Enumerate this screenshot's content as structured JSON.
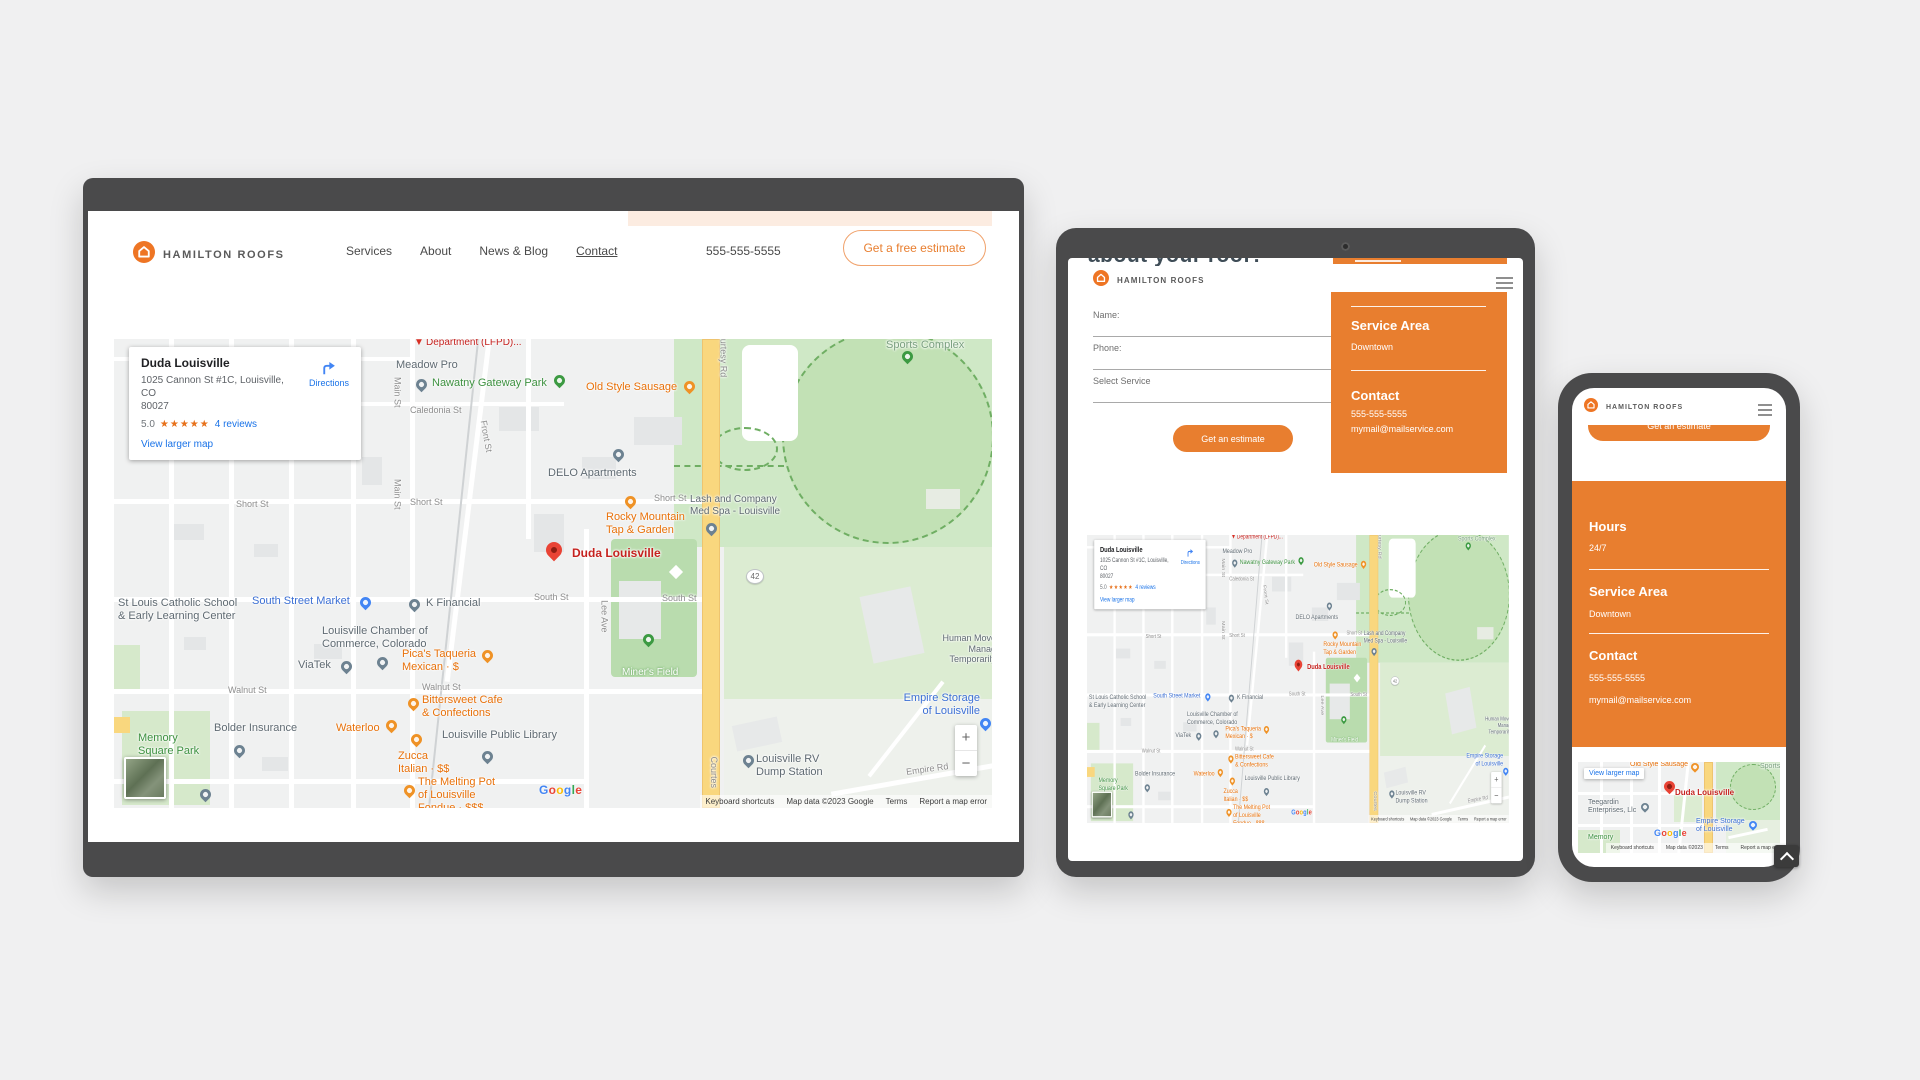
{
  "brand": {
    "name": "HAMILTON ROOFS"
  },
  "desktop": {
    "nav": [
      "Services",
      "About",
      "News & Blog",
      "Contact"
    ],
    "phone": "555-555-5555",
    "cta": "Get a free estimate"
  },
  "map": {
    "card": {
      "title": "Duda Louisville",
      "address_line1": "1025 Cannon St #1C, Louisville, CO",
      "address_line2": "80027",
      "rating": "5.0",
      "stars": "★★★★★",
      "reviews_link": "4 reviews",
      "view_larger_link": "View larger map",
      "directions_label": "Directions"
    },
    "zoom_in": "+",
    "zoom_out": "−",
    "google_logo": "Google",
    "attribution": [
      "Keyboard shortcuts",
      "Map data ©2023 Google",
      "Terms",
      "Report a map error"
    ],
    "labels": [
      {
        "t": "Department (LFPD)...",
        "x": 312,
        "y": -2,
        "c": "red"
      },
      {
        "t": "Meadow Pro",
        "x": 282,
        "y": 20,
        "c": "gray",
        "fs": 11
      },
      {
        "t": "Nawatny Gateway Park",
        "x": 318,
        "y": 38,
        "c": "green",
        "fs": 11
      },
      {
        "t": "Old Style Sausage",
        "x": 472,
        "y": 42,
        "c": "orange",
        "fs": 11
      },
      {
        "t": "Caledonia St",
        "x": 296,
        "y": 66,
        "c": "street"
      },
      {
        "t": "Main St",
        "x": 268,
        "y": 48,
        "c": "street",
        "rot": 90
      },
      {
        "t": "Main St",
        "x": 268,
        "y": 150,
        "c": "street",
        "rot": 90
      },
      {
        "t": "Front St",
        "x": 356,
        "y": 92,
        "c": "street",
        "rot": 80
      },
      {
        "t": "DELO Apartments",
        "x": 434,
        "y": 128,
        "c": "gray",
        "fs": 11
      },
      {
        "t": "Short St",
        "x": 122,
        "y": 160,
        "c": "street"
      },
      {
        "t": "Short St",
        "x": 296,
        "y": 158,
        "c": "street"
      },
      {
        "t": "Short St",
        "x": 540,
        "y": 154,
        "c": "street"
      },
      {
        "t": "Lash and Company\nMed Spa - Louisville",
        "x": 576,
        "y": 155,
        "c": "gray"
      },
      {
        "t": "Rocky Mountain\nTap & Garden",
        "x": 492,
        "y": 172,
        "c": "orange",
        "fs": 11
      },
      {
        "t": "Duda Louisville",
        "x": 458,
        "y": 207,
        "c": "red",
        "fs": 12,
        "b": 1
      },
      {
        "t": "42",
        "x": 632,
        "y": 230,
        "c": "badge"
      },
      {
        "t": "South St",
        "x": 420,
        "y": 253,
        "c": "street"
      },
      {
        "t": "South St",
        "x": 548,
        "y": 254,
        "c": "street"
      },
      {
        "t": "Lee Ave",
        "x": 474,
        "y": 272,
        "c": "street",
        "rot": 90
      },
      {
        "t": "K Financial",
        "x": 312,
        "y": 258,
        "c": "gray",
        "fs": 11
      },
      {
        "t": "St Louis Catholic School\n& Early Learning Center",
        "x": 4,
        "y": 258,
        "c": "gray",
        "fs": 11
      },
      {
        "t": "South Street Market",
        "x": 138,
        "y": 256,
        "c": "blue",
        "fs": 11
      },
      {
        "t": "Louisville Chamber of\nCommerce, Colorado",
        "x": 208,
        "y": 286,
        "c": "gray",
        "fs": 11
      },
      {
        "t": "ViaTek",
        "x": 184,
        "y": 320,
        "c": "gray",
        "fs": 11
      },
      {
        "t": "Pica's Taqueria\nMexican · $",
        "x": 288,
        "y": 309,
        "c": "orange",
        "fs": 11
      },
      {
        "t": "Walnut St",
        "x": 114,
        "y": 346,
        "c": "street"
      },
      {
        "t": "Walnut St",
        "x": 308,
        "y": 343,
        "c": "street"
      },
      {
        "t": "Bittersweet Cafe\n& Confections",
        "x": 308,
        "y": 355,
        "c": "orange",
        "fs": 11
      },
      {
        "t": "Bolder Insurance",
        "x": 100,
        "y": 383,
        "c": "gray",
        "fs": 11
      },
      {
        "t": "Waterloo",
        "x": 222,
        "y": 383,
        "c": "orange",
        "fs": 11
      },
      {
        "t": "Memory\nSquare Park",
        "x": 24,
        "y": 393,
        "c": "green",
        "fs": 11
      },
      {
        "t": "Zucca\nItalian · $$",
        "x": 284,
        "y": 411,
        "c": "orange",
        "fs": 11
      },
      {
        "t": "Louisville Public Library",
        "x": 328,
        "y": 390,
        "c": "gray",
        "fs": 11
      },
      {
        "t": "The Melting Pot\nof Louisville\nFondue · $$$",
        "x": 304,
        "y": 437,
        "c": "orange",
        "fs": 11
      },
      {
        "t": "Empire Storage\nof Louisville",
        "x": 786,
        "y": 353,
        "c": "blue",
        "fs": 11,
        "w": 80,
        "al": "right"
      },
      {
        "t": "Louisville RV\nDump Station",
        "x": 642,
        "y": 414,
        "c": "gray",
        "fs": 11
      },
      {
        "t": "Empire Rd",
        "x": 792,
        "y": 425,
        "c": "street",
        "rot": -8
      },
      {
        "t": "Human Move\nManag\nTemporarily",
        "x": 812,
        "y": 294,
        "c": "gray",
        "w": 70,
        "al": "right",
        "fs": 9
      },
      {
        "t": "Sports Complex",
        "x": 772,
        "y": 0,
        "c": "parkgray",
        "fs": 11
      },
      {
        "t": "Courtesy Rd",
        "x": 584,
        "y": 8,
        "c": "street",
        "rot": 90
      },
      {
        "t": "Courtes",
        "x": 584,
        "y": 428,
        "c": "street",
        "rot": 90
      },
      {
        "t": "Miner's Field",
        "x": 508,
        "y": 328,
        "c": "field"
      }
    ],
    "pins": [
      {
        "x": 300,
        "y": -2,
        "c": "flagred"
      },
      {
        "x": 302,
        "y": 40,
        "c": "gray"
      },
      {
        "x": 440,
        "y": 36,
        "c": "green"
      },
      {
        "x": 570,
        "y": 42,
        "c": "orange"
      },
      {
        "x": 499,
        "y": 110,
        "c": "gray"
      },
      {
        "x": 592,
        "y": 184,
        "c": "gray"
      },
      {
        "x": 511,
        "y": 157,
        "c": "orange"
      },
      {
        "x": 432,
        "y": 203,
        "c": "red",
        "s": 16
      },
      {
        "x": 295,
        "y": 260,
        "c": "gray"
      },
      {
        "x": 246,
        "y": 258,
        "c": "blue"
      },
      {
        "x": 263,
        "y": 318,
        "c": "gray"
      },
      {
        "x": 227,
        "y": 322,
        "c": "gray"
      },
      {
        "x": 368,
        "y": 311,
        "c": "orange"
      },
      {
        "x": 294,
        "y": 359,
        "c": "orange"
      },
      {
        "x": 120,
        "y": 406,
        "c": "gray"
      },
      {
        "x": 272,
        "y": 381,
        "c": "orange"
      },
      {
        "x": 297,
        "y": 395,
        "c": "orange"
      },
      {
        "x": 368,
        "y": 412,
        "c": "gray"
      },
      {
        "x": 290,
        "y": 446,
        "c": "orange"
      },
      {
        "x": 866,
        "y": 379,
        "c": "blue"
      },
      {
        "x": 629,
        "y": 416,
        "c": "gray"
      },
      {
        "x": 788,
        "y": 12,
        "c": "green"
      },
      {
        "x": 529,
        "y": 295,
        "c": "green"
      },
      {
        "x": 86,
        "y": 450,
        "c": "gray"
      }
    ]
  },
  "tablet": {
    "heading_fragment": "about your roof?",
    "form": {
      "name_label": "Name:",
      "phone_label": "Phone:",
      "service_label": "Select Service",
      "submit_label": "Get an estimate"
    },
    "info_panel": {
      "service_area_title": "Service Area",
      "service_area_value": "Downtown",
      "contact_title": "Contact",
      "contact_phone": "555-555-5555",
      "contact_email": "mymail@mailservice.com"
    }
  },
  "phone": {
    "button_fragment": "Get an estimate",
    "panel": {
      "hours_title": "Hours",
      "hours_value": "24/7",
      "service_area_title": "Service Area",
      "service_area_value": "Downtown",
      "contact_title": "Contact",
      "contact_phone": "555-555-5555",
      "contact_email": "mymail@mailservice.com"
    },
    "map": {
      "view_larger": "View larger map",
      "google_logo": "Google",
      "attribution": [
        "Keyboard shortcuts",
        "Map data ©2023",
        "Terms",
        "Report a map e"
      ],
      "labels": [
        {
          "t": "Old Style Sausage",
          "x": 52,
          "y": -1,
          "c": "orange",
          "fs": 7
        },
        {
          "t": "Sports",
          "x": 182,
          "y": 1,
          "c": "parkgray",
          "fs": 7
        },
        {
          "t": "Duda Louisville",
          "x": 97,
          "y": 26,
          "c": "red",
          "fs": 8,
          "b": 1
        },
        {
          "t": "Teegardin\nEnterprises, Llc",
          "x": 10,
          "y": 37,
          "c": "gray",
          "fs": 7
        },
        {
          "t": "Memory",
          "x": 10,
          "y": 72,
          "c": "green",
          "fs": 7
        },
        {
          "t": "Empire Storage\nof Louisville",
          "x": 118,
          "y": 56,
          "c": "blue",
          "fs": 7
        }
      ],
      "pins": [
        {
          "x": 113,
          "y": 1,
          "c": "orange",
          "s": 8
        },
        {
          "x": 86,
          "y": 19,
          "c": "red",
          "s": 11
        },
        {
          "x": 63,
          "y": 41,
          "c": "gray",
          "s": 8
        },
        {
          "x": 171,
          "y": 59,
          "c": "blue",
          "s": 8
        }
      ]
    }
  }
}
